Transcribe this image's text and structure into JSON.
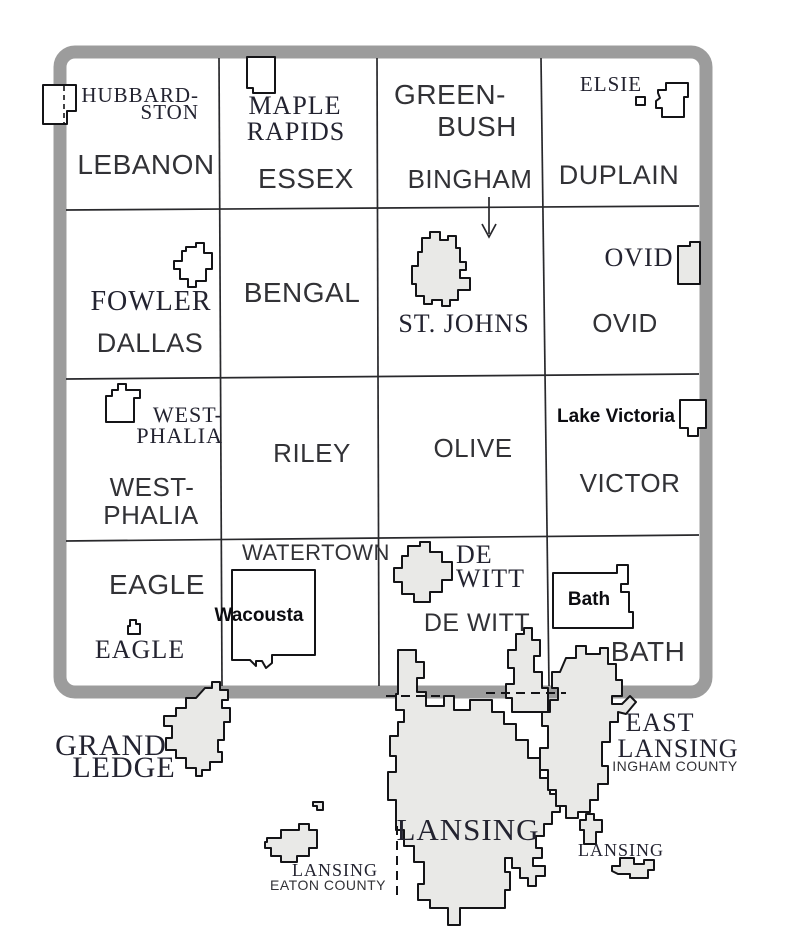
{
  "colors": {
    "county_border_gray": "#9c9c9c",
    "municipality_fill_gray": "#e9e9e7",
    "boundary_black": "#141417",
    "label_color": "#232330"
  },
  "townships": {
    "lebanon": "LEBANON",
    "essex": "ESSEX",
    "greenbush_line1": "GREEN-",
    "greenbush_line2": "BUSH",
    "bingham": "BINGHAM",
    "duplain": "DUPLAIN",
    "dallas": "DALLAS",
    "bengal": "BENGAL",
    "ovid": "OVID",
    "westphalia_line1": "WEST-",
    "westphalia_line2": "PHALIA",
    "riley": "RILEY",
    "olive": "OLIVE",
    "victor": "VICTOR",
    "eagle": "EAGLE",
    "watertown": "WATERTOWN",
    "dewitt": "DE WITT",
    "bath": "BATH"
  },
  "places": {
    "hubbardston_line1": "HUBBARD-",
    "hubbardston_line2": "STON",
    "maple_rapids_line1": "MAPLE",
    "maple_rapids_line2": "RAPIDS",
    "elsie": "ELSIE",
    "fowler": "FOWLER",
    "st_johns": "ST. JOHNS",
    "ovid_village": "OVID",
    "westphalia_line1": "WEST-",
    "westphalia_line2": "PHALIA",
    "lake_victoria": "Lake Victoria",
    "eagle_village": "EAGLE",
    "wacousta": "Wacousta",
    "dewitt_line1": "DE",
    "dewitt_line2": "WITT",
    "bath_cdp": "Bath",
    "grand_ledge_line1": "GRAND",
    "grand_ledge_line2": "LEDGE",
    "east_lansing_line1": "EAST",
    "east_lansing_line2": "LANSING",
    "east_lansing_note": "INGHAM COUNTY",
    "lansing_main": "LANSING",
    "lansing_west": "LANSING",
    "lansing_west_note": "EATON COUNTY",
    "lansing_east": "LANSING"
  }
}
